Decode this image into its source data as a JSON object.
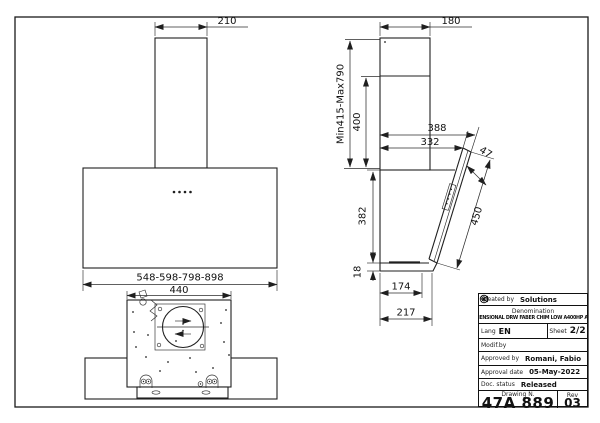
{
  "dims": {
    "front_chimney_width": "210",
    "front_body_width": "548-598-798-898",
    "plan_body_width": "440",
    "side_chimney_depth": "180",
    "side_height_range": "Min415-Max790",
    "side_chimney_lower": "400",
    "side_depth_outer": "388",
    "side_depth_inner": "332",
    "side_glass_top_offset": "47",
    "side_body_height": "382",
    "side_bottom_lip": "18",
    "side_glass_length": "450",
    "side_bottom_depth_body": "174",
    "side_bottom_depth_total": "217"
  },
  "title_block": {
    "created_by_label": "Created by",
    "created_by": "Solutions",
    "denomination_label": "Denomination",
    "denomination": "DIMENSIONAL DRW FABER CHIM LOW A400HP A400",
    "lang_label": "Lang",
    "lang": "EN",
    "sheet_label": "Sheet",
    "sheet": "2/2",
    "modif_label": "Modif.by",
    "approved_label": "Approved by",
    "approved_by": "Romani, Fabio",
    "approval_date_label": "Approval date",
    "approval_date": "05-May-2022",
    "doc_status_label": "Doc. status",
    "doc_status": "Released",
    "drawing_n_label": "Drawing N.",
    "drawing_n": "47A 889",
    "rev_label": "Rev",
    "rev": "03"
  },
  "icons": {
    "lang_flag": "tag-icon",
    "lang_globe": "globe-icon"
  },
  "colors": {
    "ink": "#1f1f1f",
    "paper": "#ffffff"
  }
}
